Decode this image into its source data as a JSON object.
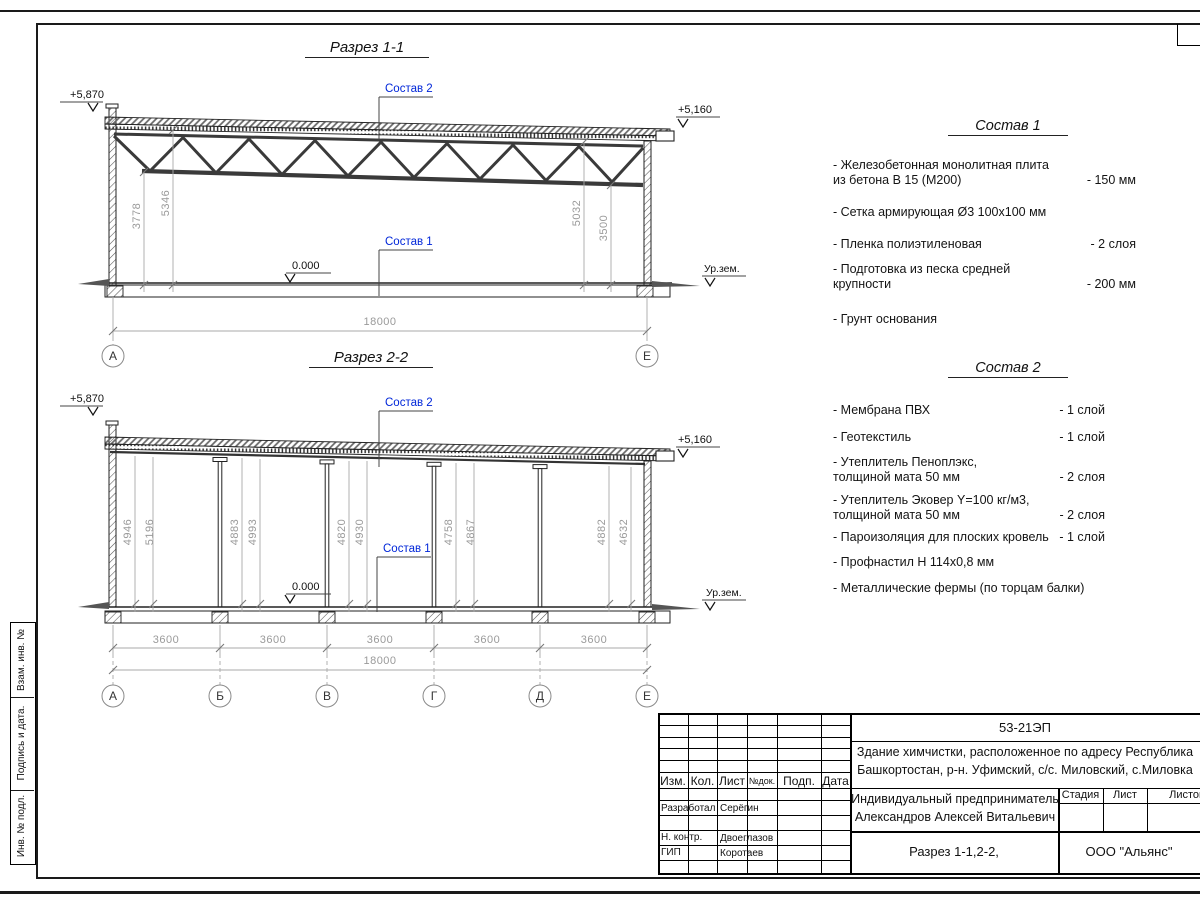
{
  "colors": {
    "accent_blue": "#0026d9",
    "dim_gray": "#9a9a9a",
    "line": "#1a1a1a"
  },
  "side_strip": {
    "labels": [
      "Взам. инв. №",
      "Подпись  и  дата.",
      "Инв. № подл."
    ]
  },
  "section1": {
    "title": "Разрез 1-1",
    "elev_left": "+5,870",
    "elev_right": "+5,160",
    "label_sostav2": "Состав 2",
    "label_sostav1": "Состав 1",
    "zero": "0.000",
    "ground": "Ур.зем.",
    "dim_left_a": "3778",
    "dim_left_b": "5346",
    "dim_right_a": "5032",
    "dim_right_b": "3500",
    "dim_total": "18000",
    "grid_a": "А",
    "grid_e": "Е"
  },
  "section2": {
    "title": "Разрез 2-2",
    "elev_left": "+5,870",
    "elev_right": "+5,160",
    "label_sostav2": "Состав 2",
    "label_sostav1": "Состав 1",
    "zero": "0.000",
    "ground": "Ур.зем.",
    "bay_dims": [
      {
        "a": "4946",
        "b": "5196"
      },
      {
        "a": "4883",
        "b": "4993"
      },
      {
        "a": "4820",
        "b": "4930"
      },
      {
        "a": "4758",
        "b": "4867"
      },
      {
        "a": "4882",
        "b": "4632"
      }
    ],
    "span_dims": [
      "3600",
      "3600",
      "3600",
      "3600",
      "3600"
    ],
    "dim_total": "18000",
    "grids": [
      "А",
      "Б",
      "В",
      "Г",
      "Д",
      "Е"
    ]
  },
  "sostav1": {
    "title": "Состав 1",
    "items": [
      {
        "text": "- Железобетонная  монолитная плита\n  из бетона В 15 (М200)",
        "value": "- 150 мм"
      },
      {
        "text": "- Сетка армирующая Ø3 100х100 мм",
        "value": ""
      },
      {
        "text": "- Пленка полиэтиленовая",
        "value": "-  2 слоя"
      },
      {
        "text": "- Подготовка из песка средней\n  крупности",
        "value": "- 200 мм"
      },
      {
        "text": "- Грунт основания",
        "value": ""
      }
    ]
  },
  "sostav2": {
    "title": "Состав 2",
    "items": [
      {
        "text": "- Мембрана ПВХ",
        "value": "- 1 слой"
      },
      {
        "text": "- Геотекстиль",
        "value": "- 1 слой"
      },
      {
        "text": "- Утеплитель Пеноплэкс,\n  толщиной мата 50 мм",
        "value": "- 2 слоя"
      },
      {
        "text": "- Утеплитель Эковер Y=100 кг/м3,\n  толщиной мата 50 мм",
        "value": "- 2 слоя"
      },
      {
        "text": "- Пароизоляция для плоских кровель",
        "value": "- 1 слой"
      },
      {
        "text": "- Профнастил Н 114х0,8 мм",
        "value": ""
      },
      {
        "text": "- Металлические фермы (по торцам балки)",
        "value": ""
      }
    ]
  },
  "titleblock": {
    "doc_code": "53-21ЭП",
    "object_line1": "Здание химчистки,  расположенное по адресу Республика",
    "object_line2": "Башкортостан, р-н. Уфимский, с/с. Миловский, с.Миловка",
    "cols": [
      "Изм.",
      "Кол.",
      "Лист",
      "№док.",
      "Подп.",
      "Дата"
    ],
    "client_line1": "Индивидуальный предприниматель",
    "client_line2": "Александров Алексей Витальевич",
    "stage": "Стадия",
    "sheet": "Лист",
    "sheets": "Листов",
    "rows": [
      {
        "role": "Разработал",
        "name": "Серёгин"
      },
      {
        "role": "Н. контр.",
        "name": "Двоеглазов"
      },
      {
        "role": "ГИП",
        "name": "Коротаев"
      }
    ],
    "sheet_name": "Разрез 1-1,2-2,",
    "company": "ООО \"Альянс\""
  }
}
